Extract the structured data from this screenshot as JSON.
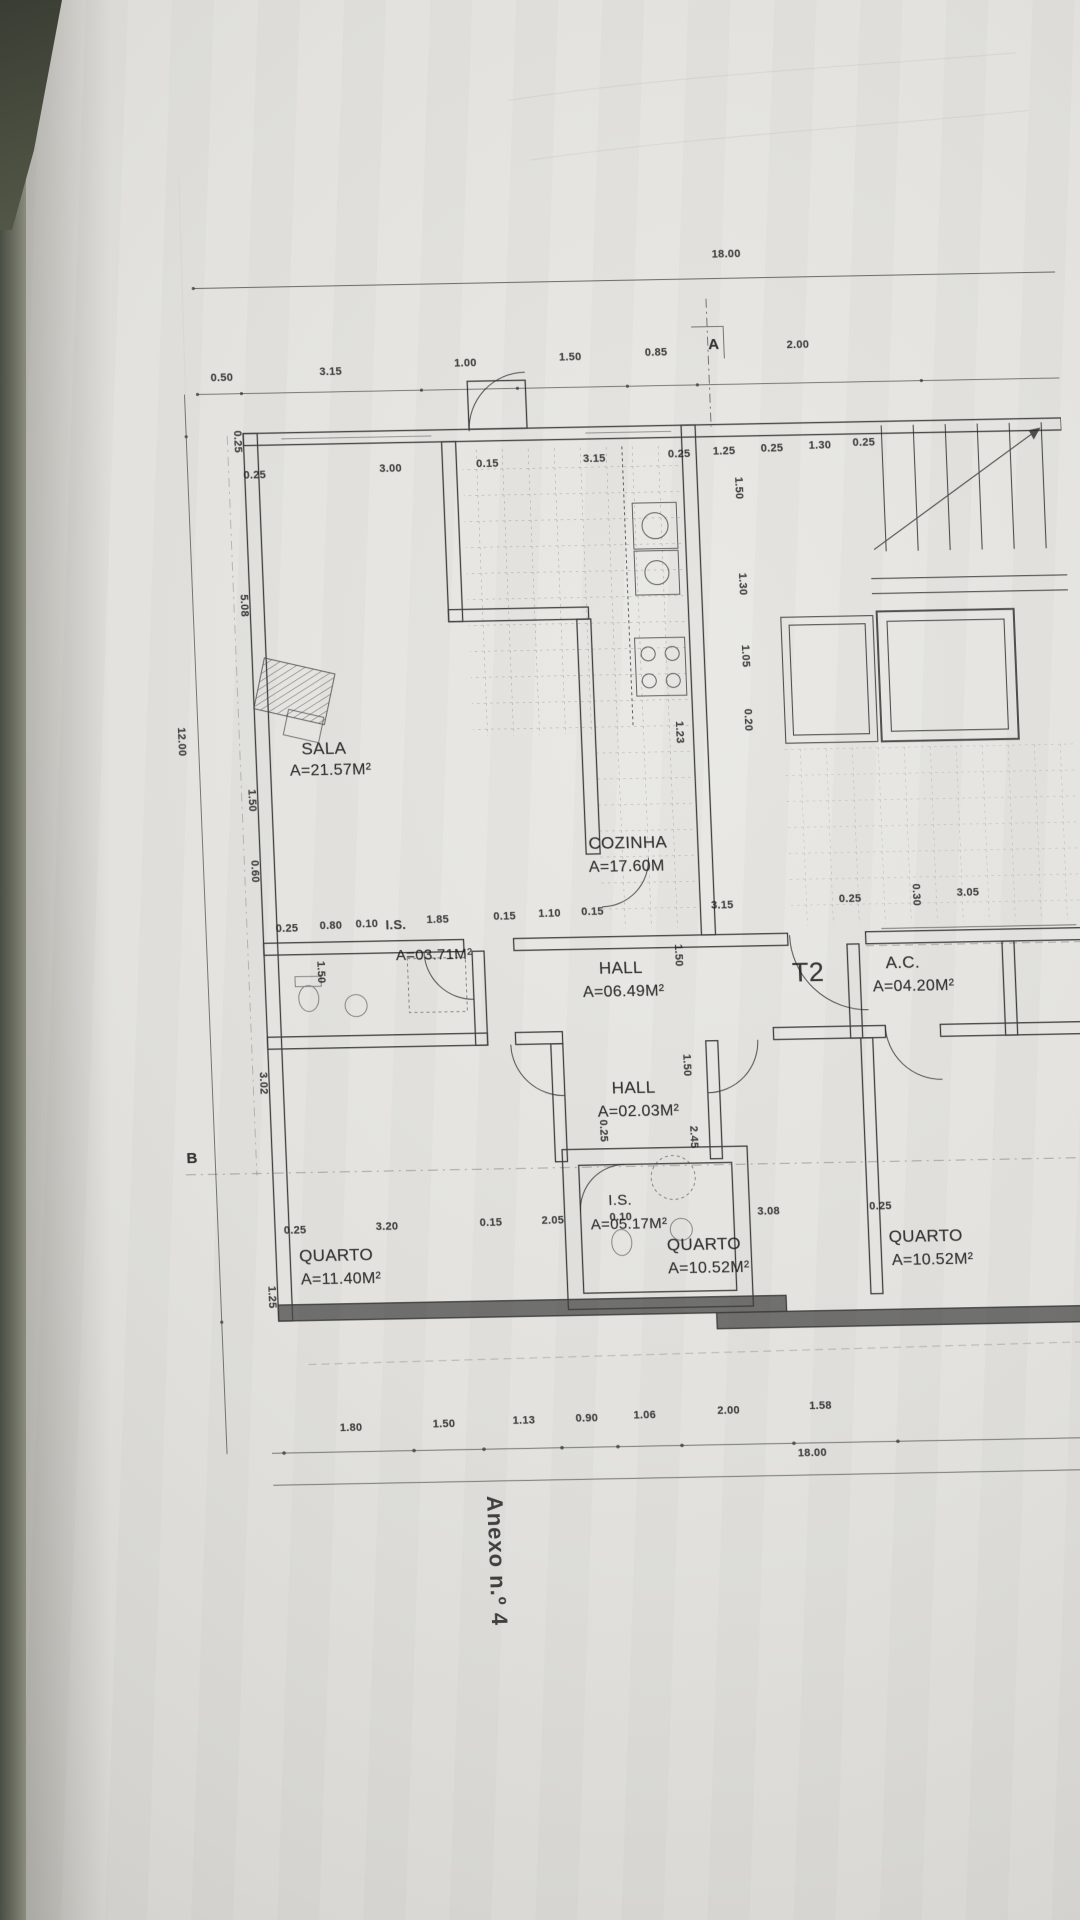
{
  "document": {
    "annex_label": "Anexo n.º 4",
    "plan_type_label": "T2"
  },
  "section_markers": {
    "a": "A",
    "b": "B"
  },
  "rooms": [
    {
      "name": "SALA",
      "area": "A=21.57M²"
    },
    {
      "name": "COZINHA",
      "area": "A=17.60M"
    },
    {
      "name": "I.S.",
      "area": "A=03.71M²"
    },
    {
      "name": "HALL",
      "area": "A=06.49M²"
    },
    {
      "name": "A.C.",
      "area": "A=04.20M²"
    },
    {
      "name": "HALL",
      "area": "A=02.03M²"
    },
    {
      "name": "I.S.",
      "area": "A=05.17M²"
    },
    {
      "name": "QUARTO",
      "area": "A=11.40M²"
    },
    {
      "name": "QUARTO",
      "area": "A=10.52M²"
    },
    {
      "name": "QUARTO",
      "area": "A=10.52M²"
    }
  ],
  "dimensions": {
    "top_total": "18.00",
    "bottom_total": "18.00",
    "left_total": "12.00",
    "top_row": [
      "0.50",
      "3.15",
      "1.00",
      "1.50",
      "0.85",
      "2.00"
    ],
    "upper_inner_row": [
      "0.25",
      "3.00",
      "0.15",
      "3.15",
      "0.25"
    ],
    "upper_right_row": [
      "1.25",
      "0.25",
      "1.30",
      "0.25"
    ],
    "mid_row_left": [
      "0.25",
      "0.80",
      "0.10",
      "1.85"
    ],
    "mid_row_center": [
      "0.15",
      "1.10",
      "0.15"
    ],
    "mid_row_right": [
      "3.15",
      "0.25",
      "3.05"
    ],
    "bottom_inner_row": [
      "0.25",
      "3.20",
      "0.15",
      "2.05",
      "0.10",
      "3.08",
      "0.25"
    ],
    "bottom_row": [
      "1.80",
      "1.50",
      "1.13",
      "0.90",
      "1.06",
      "2.00",
      "1.58"
    ],
    "left_side": [
      "0.25",
      "5.08",
      "1.50",
      "0.60",
      "3.02",
      "1.25"
    ],
    "right_side": [
      "1.50",
      "1.30",
      "1.05",
      "0.20",
      "0.30"
    ],
    "inner_vertical": [
      "1.50",
      "1.50",
      "1.50",
      "2.45",
      "1.23",
      "0.25"
    ]
  }
}
